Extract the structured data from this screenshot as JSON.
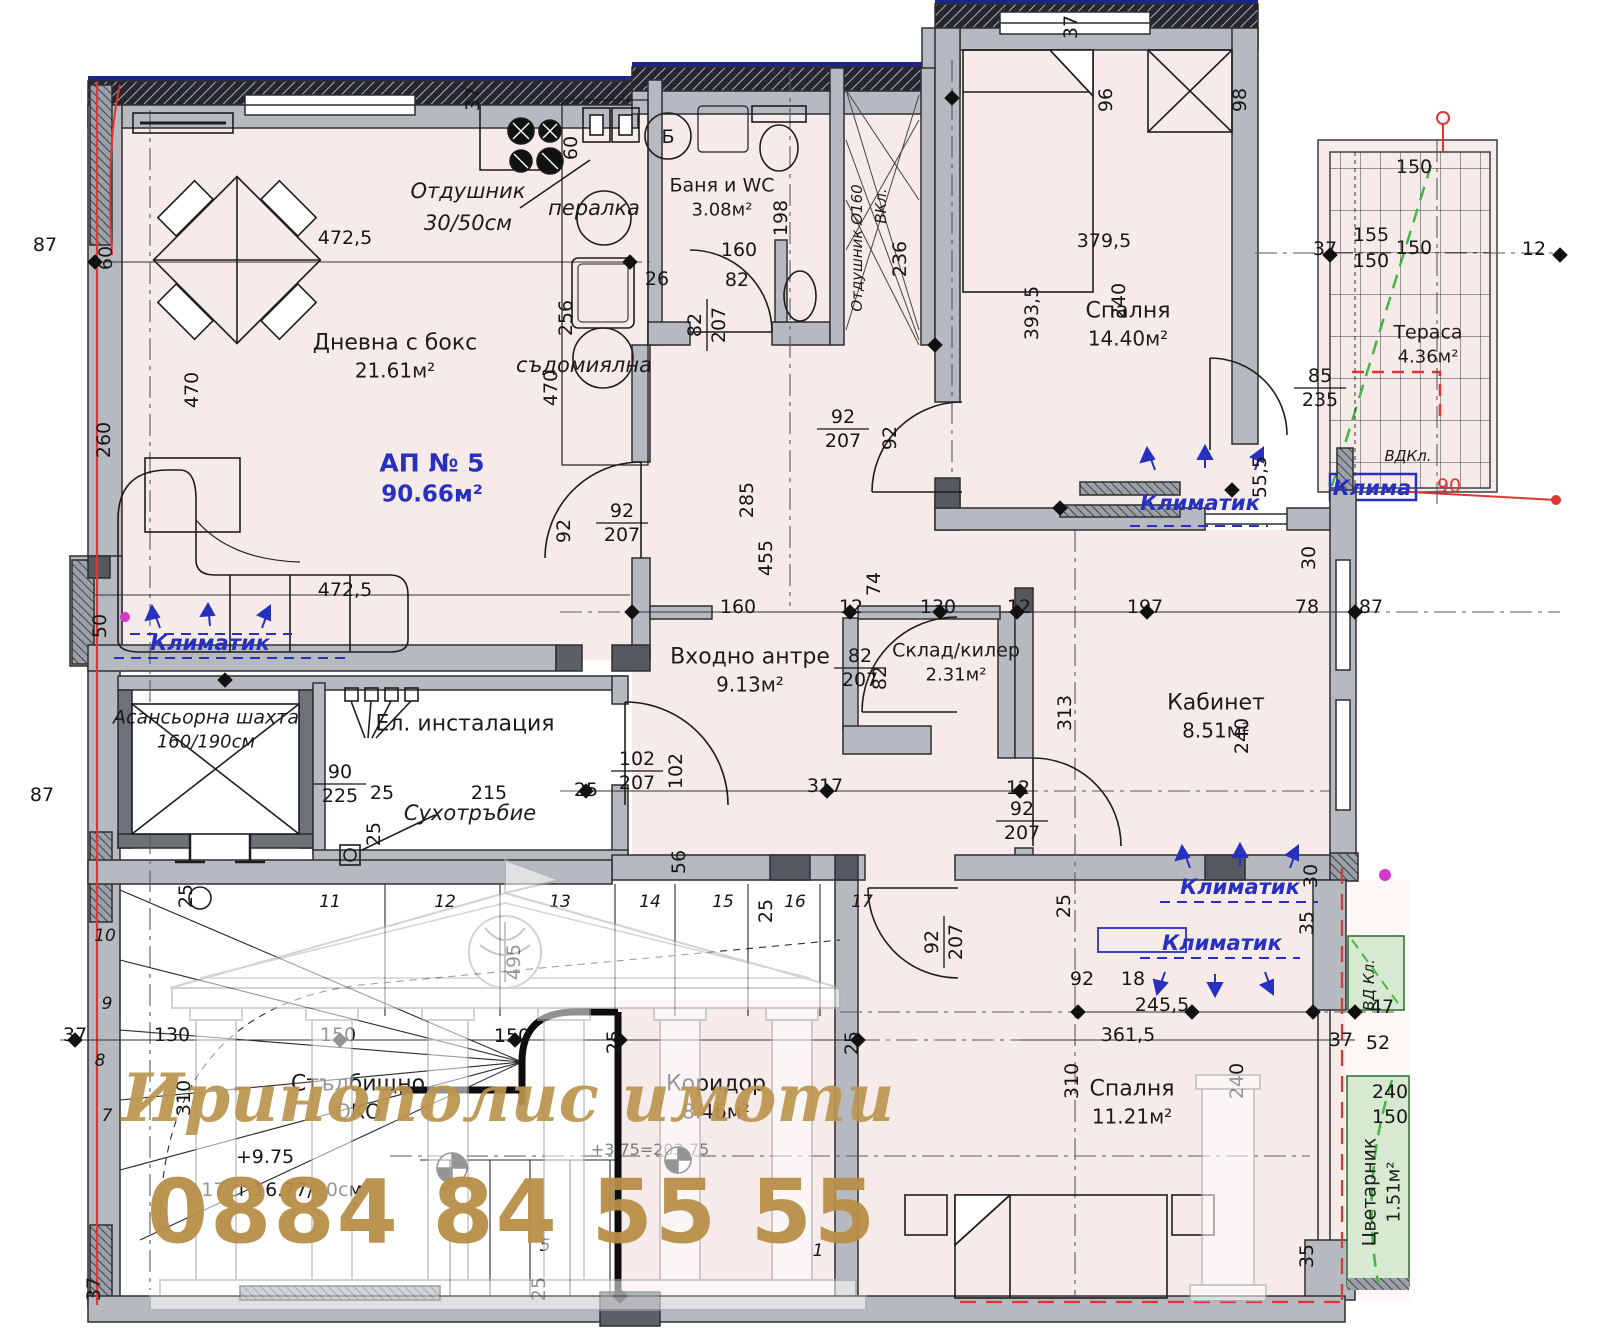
{
  "apartment": {
    "id": "АП № 5",
    "area": "90.66м²"
  },
  "watermark": {
    "brand": "Иринополис имоти",
    "phone": "0884 84 55 55"
  },
  "rooms": [
    {
      "name": "Дневна с бокс",
      "area": "21.61м²"
    },
    {
      "name": "Баня и WC",
      "area": "3.08м²"
    },
    {
      "name": "Спалня",
      "area": "14.40м²"
    },
    {
      "name": "Тераса",
      "area": "4.36м²"
    },
    {
      "name": "Входно антре",
      "area": "9.13м²"
    },
    {
      "name": "Склад/килер",
      "area": "2.31м²"
    },
    {
      "name": "Кабинет",
      "area": "8.51м²"
    },
    {
      "name": "Коридор",
      "area": "8.46м²"
    },
    {
      "name": "Спалня",
      "area": "11.21м²"
    },
    {
      "name": "Цветарник",
      "area": "1.51м²"
    },
    {
      "name": "Асансьорна шахта",
      "area": "160/190см"
    },
    {
      "name": "Стълбищно",
      "area": "ОКО"
    },
    {
      "name": "Ел. инсталация",
      "area": ""
    }
  ],
  "annotations": [
    {
      "t": "Отдушник",
      "x": 468,
      "y": 198,
      "cls": "ann"
    },
    {
      "t": "30/50см",
      "x": 468,
      "y": 230,
      "cls": "ann"
    },
    {
      "t": "пералка",
      "x": 594,
      "y": 215,
      "cls": "ann"
    },
    {
      "t": "съдомиялна",
      "x": 584,
      "y": 372,
      "cls": "ann"
    },
    {
      "t": "Сухотръбие",
      "x": 470,
      "y": 820,
      "cls": "ann"
    },
    {
      "t": "Отдушник Ø160",
      "x": 862,
      "y": 248,
      "r": -90,
      "cls": "ann sm"
    },
    {
      "t": "ВКл.",
      "x": 886,
      "y": 206,
      "r": -90,
      "cls": "ann sm"
    },
    {
      "t": "Б",
      "x": 668,
      "y": 143,
      "cls": "dim"
    },
    {
      "t": "Климатик",
      "x": 210,
      "y": 650,
      "cls": "ann blue"
    },
    {
      "t": "Климатик",
      "x": 1200,
      "y": 510,
      "cls": "ann blue"
    },
    {
      "t": "Климатик",
      "x": 1240,
      "y": 894,
      "cls": "ann blue"
    },
    {
      "t": "Климатик",
      "x": 1222,
      "y": 950,
      "cls": "ann blue"
    },
    {
      "t": "Клима",
      "x": 1372,
      "y": 495,
      "cls": "ann blue",
      "sz": 17
    },
    {
      "t": "ВДКл.",
      "x": 1408,
      "y": 461,
      "cls": "ann sm"
    },
    {
      "t": "ВД Кл.",
      "x": 1374,
      "y": 985,
      "r": -90,
      "cls": "ann sm"
    },
    {
      "t": "90",
      "x": 1449,
      "y": 492,
      "cls": "dim red"
    },
    {
      "t": "+9.75",
      "x": 265,
      "y": 1163,
      "cls": "dim"
    },
    {
      "t": "17ст.16.77/80см",
      "x": 282,
      "y": 1196,
      "cls": "dim"
    },
    {
      "t": "+3.75=203.75",
      "x": 650,
      "y": 1155,
      "cls": "dim faint"
    }
  ],
  "dimensions": [
    {
      "t": "87",
      "x": 45,
      "y": 251
    },
    {
      "t": "60",
      "x": 112,
      "y": 258,
      "r": -90
    },
    {
      "t": "472,5",
      "x": 345,
      "y": 244
    },
    {
      "t": "37",
      "x": 479,
      "y": 99,
      "r": -90
    },
    {
      "t": "60",
      "x": 577,
      "y": 148,
      "r": -90
    },
    {
      "t": "470",
      "x": 198,
      "y": 390,
      "r": -90
    },
    {
      "t": "260",
      "x": 110,
      "y": 440,
      "r": -90
    },
    {
      "t": "256",
      "x": 572,
      "y": 318,
      "r": -90
    },
    {
      "t": "470",
      "x": 557,
      "y": 388,
      "r": -90
    },
    {
      "t": "472,5",
      "x": 345,
      "y": 596
    },
    {
      "t": "50",
      "x": 106,
      "y": 626,
      "r": -90
    },
    {
      "t": "92",
      "x": 570,
      "y": 531,
      "r": -90
    },
    {
      "t": "285",
      "x": 753,
      "y": 500,
      "r": -90
    },
    {
      "t": "455",
      "x": 772,
      "y": 558,
      "r": -90
    },
    {
      "t": "25",
      "x": 380,
      "y": 834,
      "r": -90
    },
    {
      "t": "87",
      "x": 42,
      "y": 801
    },
    {
      "t": "160",
      "x": 739,
      "y": 256
    },
    {
      "t": "26",
      "x": 657,
      "y": 285
    },
    {
      "t": "82",
      "x": 737,
      "y": 286
    },
    {
      "t": "198",
      "x": 787,
      "y": 218,
      "r": -90
    },
    {
      "t": "236",
      "x": 906,
      "y": 259,
      "r": -90
    },
    {
      "t": "92",
      "x": 896,
      "y": 438,
      "r": -90
    },
    {
      "t": "379,5",
      "x": 1104,
      "y": 247
    },
    {
      "t": "393,5",
      "x": 1038,
      "y": 313,
      "r": -90
    },
    {
      "t": "96",
      "x": 1112,
      "y": 100,
      "r": -90
    },
    {
      "t": "98",
      "x": 1246,
      "y": 100,
      "r": -90
    },
    {
      "t": "240",
      "x": 1125,
      "y": 301,
      "r": -90
    },
    {
      "t": "37",
      "x": 1077,
      "y": 27,
      "r": -90
    },
    {
      "t": "150",
      "x": 1414,
      "y": 173
    },
    {
      "t": "155",
      "x": 1371,
      "y": 241
    },
    {
      "t": "150",
      "x": 1414,
      "y": 254
    },
    {
      "t": "150",
      "x": 1371,
      "y": 267
    },
    {
      "t": "37",
      "x": 1325,
      "y": 255
    },
    {
      "t": "12",
      "x": 1534,
      "y": 255
    },
    {
      "t": "55,5",
      "x": 1266,
      "y": 477,
      "r": -90
    },
    {
      "t": "30",
      "x": 1315,
      "y": 558,
      "r": -90
    },
    {
      "t": "160",
      "x": 738,
      "y": 613
    },
    {
      "t": "12",
      "x": 851,
      "y": 613
    },
    {
      "t": "130",
      "x": 938,
      "y": 613
    },
    {
      "t": "12",
      "x": 1019,
      "y": 613
    },
    {
      "t": "197",
      "x": 1145,
      "y": 613
    },
    {
      "t": "78",
      "x": 1307,
      "y": 613
    },
    {
      "t": "87",
      "x": 1371,
      "y": 613
    },
    {
      "t": "74",
      "x": 880,
      "y": 584,
      "r": -90
    },
    {
      "t": "82",
      "x": 886,
      "y": 678,
      "r": -90
    },
    {
      "t": "313",
      "x": 1071,
      "y": 713,
      "r": -90
    },
    {
      "t": "240",
      "x": 1248,
      "y": 736,
      "r": -90
    },
    {
      "t": "25",
      "x": 382,
      "y": 799
    },
    {
      "t": "215",
      "x": 489,
      "y": 799
    },
    {
      "t": "25",
      "x": 586,
      "y": 796
    },
    {
      "t": "102",
      "x": 682,
      "y": 771,
      "r": -90
    },
    {
      "t": "317",
      "x": 825,
      "y": 792
    },
    {
      "t": "12",
      "x": 1018,
      "y": 794
    },
    {
      "t": "56",
      "x": 685,
      "y": 862,
      "r": -90
    },
    {
      "t": "25",
      "x": 772,
      "y": 911,
      "r": -90
    },
    {
      "t": "30",
      "x": 1317,
      "y": 876,
      "r": -90
    },
    {
      "t": "35",
      "x": 1313,
      "y": 923,
      "r": -90
    },
    {
      "t": "25",
      "x": 1070,
      "y": 906,
      "r": -90
    },
    {
      "t": "92",
      "x": 1082,
      "y": 985
    },
    {
      "t": "18",
      "x": 1133,
      "y": 985
    },
    {
      "t": "245,5",
      "x": 1162,
      "y": 1011
    },
    {
      "t": "361,5",
      "x": 1128,
      "y": 1041
    },
    {
      "t": "310",
      "x": 1078,
      "y": 1081,
      "r": -90
    },
    {
      "t": "240",
      "x": 1243,
      "y": 1081,
      "r": -90
    },
    {
      "t": "37",
      "x": 1341,
      "y": 1046
    },
    {
      "t": "47",
      "x": 1382,
      "y": 1013
    },
    {
      "t": "52",
      "x": 1378,
      "y": 1049
    },
    {
      "t": "240",
      "x": 1390,
      "y": 1098
    },
    {
      "t": "150",
      "x": 1390,
      "y": 1123
    },
    {
      "t": "35",
      "x": 1313,
      "y": 1256,
      "r": -90
    },
    {
      "t": "25",
      "x": 545,
      "y": 1289,
      "r": -90
    },
    {
      "t": "37",
      "x": 100,
      "y": 1289,
      "r": -90
    },
    {
      "t": "37",
      "x": 75,
      "y": 1041
    },
    {
      "t": "130",
      "x": 172,
      "y": 1041
    },
    {
      "t": "310",
      "x": 190,
      "y": 1098,
      "r": -90
    },
    {
      "t": "25",
      "x": 192,
      "y": 896,
      "r": -90
    },
    {
      "t": "150",
      "x": 338,
      "y": 1041
    },
    {
      "t": "150",
      "x": 512,
      "y": 1042
    },
    {
      "t": "25",
      "x": 620,
      "y": 1042,
      "r": -90
    },
    {
      "t": "25",
      "x": 858,
      "y": 1043,
      "r": -90
    },
    {
      "t": "495",
      "x": 520,
      "y": 962,
      "r": -90
    },
    {
      "t": "10",
      "x": 105,
      "y": 941,
      "s": "step"
    },
    {
      "t": "9",
      "x": 107,
      "y": 1009,
      "s": "step"
    },
    {
      "t": "8",
      "x": 100,
      "y": 1066,
      "s": "step"
    },
    {
      "t": "7",
      "x": 107,
      "y": 1121,
      "s": "step"
    },
    {
      "t": "11",
      "x": 330,
      "y": 907,
      "s": "step"
    },
    {
      "t": "12",
      "x": 445,
      "y": 907,
      "s": "step"
    },
    {
      "t": "13",
      "x": 560,
      "y": 907,
      "s": "step"
    },
    {
      "t": "14",
      "x": 650,
      "y": 907,
      "s": "step"
    },
    {
      "t": "15",
      "x": 723,
      "y": 907,
      "s": "step"
    },
    {
      "t": "16",
      "x": 795,
      "y": 907,
      "s": "step"
    },
    {
      "t": "17",
      "x": 862,
      "y": 907,
      "s": "step"
    },
    {
      "t": "5",
      "x": 545,
      "y": 1251,
      "s": "step"
    },
    {
      "t": "1",
      "x": 818,
      "y": 1256,
      "s": "step"
    }
  ],
  "fractions": [
    {
      "num": "92",
      "den": "207",
      "x": 843,
      "y": 426
    },
    {
      "num": "92",
      "den": "207",
      "x": 622,
      "y": 520
    },
    {
      "num": "82",
      "den": "207",
      "x": 704,
      "y": 325,
      "r": -90
    },
    {
      "num": "82",
      "den": "207",
      "x": 860,
      "y": 665
    },
    {
      "num": "102",
      "den": "207",
      "x": 637,
      "y": 768
    },
    {
      "num": "92",
      "den": "207",
      "x": 1022,
      "y": 818
    },
    {
      "num": "92",
      "den": "207",
      "x": 941,
      "y": 942,
      "r": -90
    },
    {
      "num": "90",
      "den": "225",
      "x": 340,
      "y": 781
    },
    {
      "num": "85",
      "den": "235",
      "x": 1320,
      "y": 385
    },
    {
      "num": "92",
      "den": "207",
      "x": 733,
      "y": 1098,
      "hidden": true
    }
  ],
  "markers": [
    {
      "x": 95,
      "y": 262
    },
    {
      "x": 630,
      "y": 262
    },
    {
      "x": 632,
      "y": 612
    },
    {
      "x": 850,
      "y": 612
    },
    {
      "x": 940,
      "y": 612
    },
    {
      "x": 1017,
      "y": 612
    },
    {
      "x": 1147,
      "y": 612
    },
    {
      "x": 1355,
      "y": 612
    },
    {
      "x": 586,
      "y": 791
    },
    {
      "x": 827,
      "y": 791
    },
    {
      "x": 1020,
      "y": 791
    },
    {
      "x": 75,
      "y": 1040
    },
    {
      "x": 340,
      "y": 1040
    },
    {
      "x": 515,
      "y": 1040
    },
    {
      "x": 620,
      "y": 1040
    },
    {
      "x": 858,
      "y": 1040
    },
    {
      "x": 1078,
      "y": 1012
    },
    {
      "x": 1192,
      "y": 1012
    },
    {
      "x": 1313,
      "y": 1012
    },
    {
      "x": 1330,
      "y": 255
    },
    {
      "x": 1560,
      "y": 255
    },
    {
      "x": 935,
      "y": 345
    },
    {
      "x": 1060,
      "y": 508
    },
    {
      "x": 1355,
      "y": 1012
    },
    {
      "x": 225,
      "y": 680
    },
    {
      "x": 952,
      "y": 98
    },
    {
      "x": 1232,
      "y": 490
    },
    {
      "x": 620,
      "y": 1296
    }
  ],
  "colors": {
    "room_fill": "#f7ebea",
    "wall": "#b6bac0",
    "wall_dark": "#5d6066",
    "black": "#111111",
    "blue": "#2731be",
    "navy": "#1e2590",
    "red": "#e03535",
    "green": "#3d9e3d",
    "green_fill": "#d7e9d1",
    "gold": "#bb944f"
  }
}
